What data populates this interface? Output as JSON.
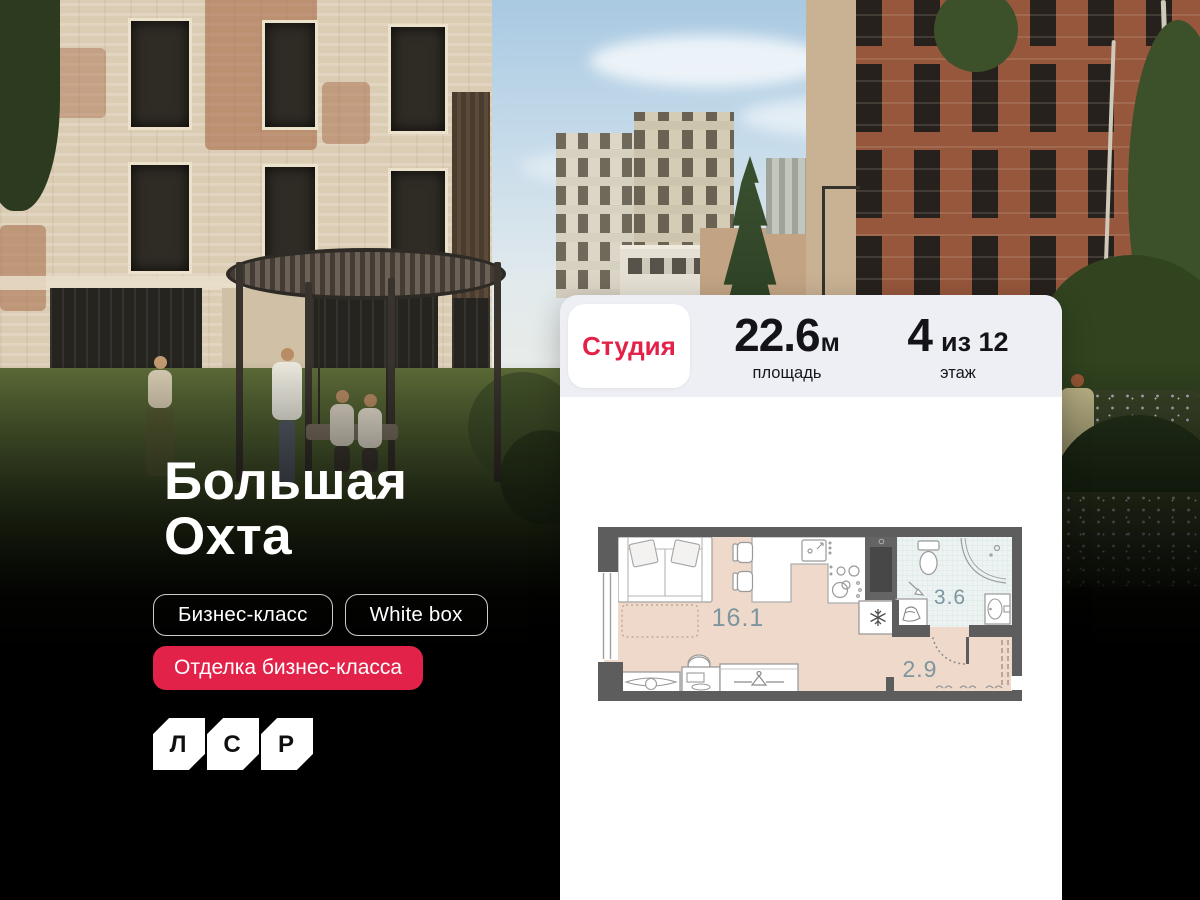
{
  "hero": {
    "project_title_line1": "Большая",
    "project_title_line2": "Охта",
    "tag_business_class": "Бизнес-класс",
    "tag_white_box": "White box",
    "badge_finishing": "Отделка бизнес-класса",
    "logo_letter_1": "Л",
    "logo_letter_2": "С",
    "logo_letter_3": "Р"
  },
  "listing_card": {
    "type_badge": "Студия",
    "area_value": "22.6",
    "area_unit": "м",
    "area_caption": "площадь",
    "floor_value": "4",
    "floor_suffix": "из 12",
    "floor_caption": "этаж"
  },
  "floor_plan": {
    "living_area": "16.1",
    "bathroom_area": "3.6",
    "hallway_area": "2.9"
  },
  "colors": {
    "accent_red": "#e3224a",
    "card_header_bg": "#edeff4",
    "plan_floor": "#eed9cb",
    "plan_bathroom_floor": "#edf3f2",
    "plan_wall": "#5d5d5d",
    "plan_label": "#7d959e"
  }
}
